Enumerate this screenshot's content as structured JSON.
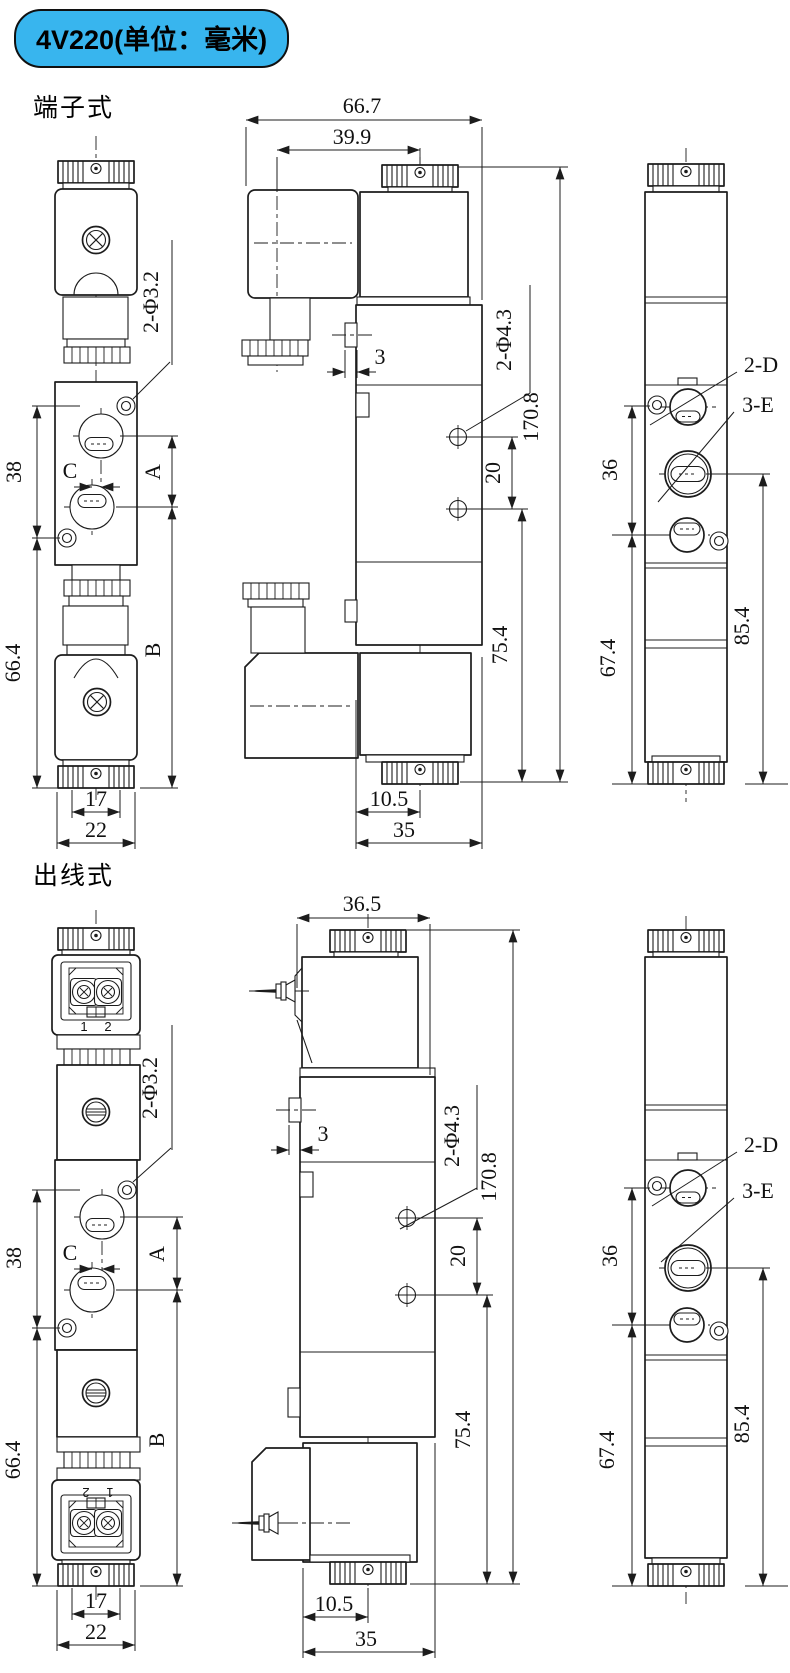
{
  "page": {
    "title_badge": "4V220(单位：毫米)"
  },
  "colors": {
    "badge_bg": "#38b5ee",
    "badge_border": "#101010",
    "ink": "#1c1c1c"
  },
  "sections": [
    {
      "label": "端子式",
      "side_view": {
        "hole_label": "2-Φ3.2",
        "dim_38": "38",
        "dim_66_4": "66.4",
        "dim_c": "C",
        "dim_a": "A",
        "dim_b": "B",
        "dim_17": "17",
        "dim_22": "22"
      },
      "front_view": {
        "dim_66_7": "66.7",
        "dim_39_9": "39.9",
        "dim_3": "3",
        "hole_label": "2-Φ4.3",
        "dim_20": "20",
        "dim_170_8": "170.8",
        "dim_75_4": "75.4",
        "dim_10_5": "10.5",
        "dim_35": "35"
      },
      "end_view": {
        "label_2d": "2-D",
        "label_3e": "3-E",
        "dim_36": "36",
        "dim_67_4": "67.4",
        "dim_85_4": "85.4"
      }
    },
    {
      "label": "出线式",
      "side_view": {
        "terminal_1": "1",
        "terminal_2": "2",
        "hole_label": "2-Φ3.2",
        "dim_38": "38",
        "dim_66_4": "66.4",
        "dim_c": "C",
        "dim_a": "A",
        "dim_b": "B",
        "dim_17": "17",
        "dim_22": "22"
      },
      "front_view": {
        "dim_36_5": "36.5",
        "dim_3": "3",
        "hole_label": "2-Φ4.3",
        "dim_20": "20",
        "dim_170_8": "170.8",
        "dim_75_4": "75.4",
        "dim_10_5": "10.5",
        "dim_35": "35"
      },
      "end_view": {
        "label_2d": "2-D",
        "label_3e": "3-E",
        "dim_36": "36",
        "dim_67_4": "67.4",
        "dim_85_4": "85.4"
      }
    }
  ]
}
